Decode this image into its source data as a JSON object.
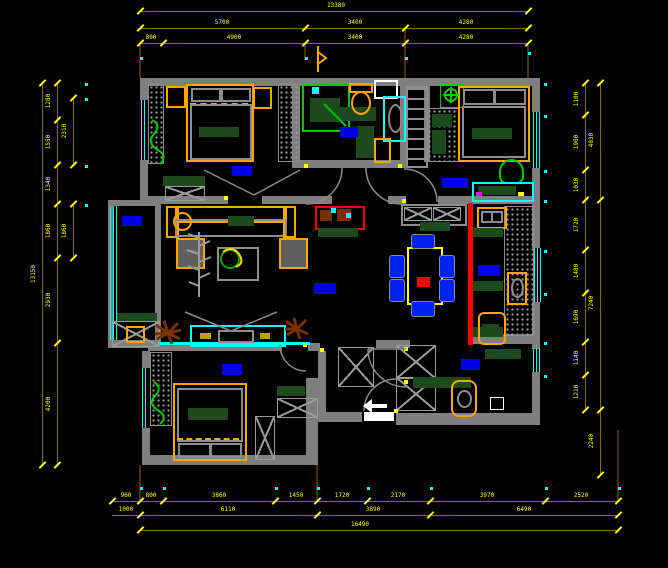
{
  "canvas": {
    "width": 668,
    "height": 568,
    "background": "#000000"
  },
  "palette": {
    "wall": "#7f7f7f",
    "dim_line": "#8a6d00",
    "dim_text": "#ffff00",
    "end_dot": "#00ffff",
    "window": "#00ffff",
    "room_label_bg": "#0000e6",
    "furniture_frame": "#ffa500",
    "plant_green": "#00cc00",
    "cabinet_green": "#1d4a1d",
    "chair_blue": "#0022ee",
    "sliding_door_red": "#ff0000",
    "dry_plant_brown": "#7a2f00",
    "entry_marker_white": "#ffffff"
  },
  "dim": {
    "h": [
      {
        "y": 11,
        "x1": 140,
        "x2": 528,
        "ticks": [
          140,
          528
        ],
        "labels": [
          {
            "t": "13380",
            "x": 336
          }
        ]
      },
      {
        "y": 28,
        "x1": 140,
        "x2": 528,
        "ticks": [
          140,
          305,
          405,
          528
        ],
        "labels": [
          {
            "t": "5700",
            "x": 222
          },
          {
            "t": "3400",
            "x": 355
          },
          {
            "t": "4280",
            "x": 466
          }
        ]
      },
      {
        "y": 43,
        "x1": 140,
        "x2": 528,
        "ticks": [
          140,
          163,
          305,
          405,
          528
        ],
        "labels": [
          {
            "t": "800",
            "x": 151
          },
          {
            "t": "4900",
            "x": 234
          },
          {
            "t": "3400",
            "x": 355
          },
          {
            "t": "4280",
            "x": 466
          }
        ]
      },
      {
        "y": 501,
        "x1": 112,
        "x2": 618,
        "ticks": [
          112,
          140,
          163,
          275,
          317,
          367,
          430,
          545,
          618
        ],
        "labels": [
          {
            "t": "960",
            "x": 126
          },
          {
            "t": "800",
            "x": 151
          },
          {
            "t": "3860",
            "x": 219
          },
          {
            "t": "1450",
            "x": 296
          },
          {
            "t": "1720",
            "x": 342
          },
          {
            "t": "2170",
            "x": 398
          },
          {
            "t": "3970",
            "x": 487
          },
          {
            "t": "2520",
            "x": 581
          }
        ]
      },
      {
        "y": 515,
        "x1": 112,
        "x2": 618,
        "ticks": [
          140,
          317,
          430,
          618
        ],
        "labels": [
          {
            "t": "1000",
            "x": 126
          },
          {
            "t": "6110",
            "x": 228
          },
          {
            "t": "3890",
            "x": 373
          },
          {
            "t": "6490",
            "x": 524
          }
        ]
      },
      {
        "y": 530,
        "x1": 140,
        "x2": 618,
        "ticks": [
          140,
          618
        ],
        "labels": [
          {
            "t": "16490",
            "x": 360
          }
        ]
      }
    ],
    "v": [
      {
        "x": 42,
        "y1": 83,
        "y2": 465,
        "ticks": [
          83,
          465
        ],
        "labels": [
          {
            "t": "13150",
            "y": 274
          }
        ]
      },
      {
        "x": 57,
        "y1": 83,
        "y2": 465,
        "ticks": [
          83,
          120,
          165,
          204,
          258,
          343,
          465
        ],
        "labels": [
          {
            "t": "1280",
            "y": 101
          },
          {
            "t": "1550",
            "y": 142
          },
          {
            "t": "1340",
            "y": 184
          },
          {
            "t": "1860",
            "y": 231
          },
          {
            "t": "2930",
            "y": 300
          },
          {
            "t": "4200",
            "y": 404
          }
        ]
      },
      {
        "x": 73,
        "y1": 98,
        "y2": 165,
        "ticks": [
          98,
          165
        ],
        "labels": [
          {
            "t": "2310",
            "y": 131
          }
        ]
      },
      {
        "x": 73,
        "y1": 204,
        "y2": 258,
        "ticks": [
          204,
          258
        ],
        "labels": [
          {
            "t": "1860",
            "y": 231
          }
        ]
      },
      {
        "x": 585,
        "y1": 83,
        "y2": 410,
        "ticks": [
          83,
          115,
          170,
          200,
          250,
          293,
          342,
          375,
          410
        ],
        "labels": [
          {
            "t": "1100",
            "y": 99
          },
          {
            "t": "1900",
            "y": 142
          },
          {
            "t": "1030",
            "y": 185
          },
          {
            "t": "1720",
            "y": 225
          },
          {
            "t": "1480",
            "y": 271
          },
          {
            "t": "1690",
            "y": 317
          },
          {
            "t": "1140",
            "y": 358
          },
          {
            "t": "1210",
            "y": 392
          }
        ]
      },
      {
        "x": 600,
        "y1": 83,
        "y2": 475,
        "ticks": [
          83,
          200,
          410,
          475
        ],
        "labels": [
          {
            "t": "4030",
            "y": 140
          },
          {
            "t": "7240",
            "y": 303
          },
          {
            "t": "2240",
            "y": 441
          }
        ]
      }
    ],
    "dots": [
      {
        "x": 140,
        "y": 57
      },
      {
        "x": 305,
        "y": 57
      },
      {
        "x": 405,
        "y": 57
      },
      {
        "x": 528,
        "y": 52
      },
      {
        "x": 140,
        "y": 487
      },
      {
        "x": 163,
        "y": 487
      },
      {
        "x": 275,
        "y": 487
      },
      {
        "x": 317,
        "y": 487
      },
      {
        "x": 367,
        "y": 487
      },
      {
        "x": 430,
        "y": 487
      },
      {
        "x": 545,
        "y": 487
      },
      {
        "x": 618,
        "y": 487
      },
      {
        "x": 85,
        "y": 83
      },
      {
        "x": 85,
        "y": 98
      },
      {
        "x": 85,
        "y": 165
      },
      {
        "x": 85,
        "y": 204
      },
      {
        "x": 544,
        "y": 83
      },
      {
        "x": 544,
        "y": 115
      },
      {
        "x": 544,
        "y": 170
      },
      {
        "x": 544,
        "y": 200
      },
      {
        "x": 544,
        "y": 250
      },
      {
        "x": 544,
        "y": 293
      },
      {
        "x": 544,
        "y": 342
      },
      {
        "x": 544,
        "y": 375
      }
    ]
  },
  "room_labels": [
    {
      "name": "master-bedroom",
      "x": 232,
      "y": 166,
      "w": 20,
      "h": 10
    },
    {
      "name": "bathroom",
      "x": 340,
      "y": 127,
      "w": 18,
      "h": 10
    },
    {
      "name": "bedroom-2",
      "x": 442,
      "y": 178,
      "w": 26,
      "h": 10
    },
    {
      "name": "balcony",
      "x": 122,
      "y": 216,
      "w": 20,
      "h": 10
    },
    {
      "name": "living-room",
      "x": 314,
      "y": 283,
      "w": 22,
      "h": 11
    },
    {
      "name": "kitchen",
      "x": 478,
      "y": 265,
      "w": 22,
      "h": 11
    },
    {
      "name": "bedroom-3",
      "x": 222,
      "y": 364,
      "w": 20,
      "h": 11
    },
    {
      "name": "entry",
      "x": 461,
      "y": 359,
      "w": 19,
      "h": 11
    }
  ]
}
